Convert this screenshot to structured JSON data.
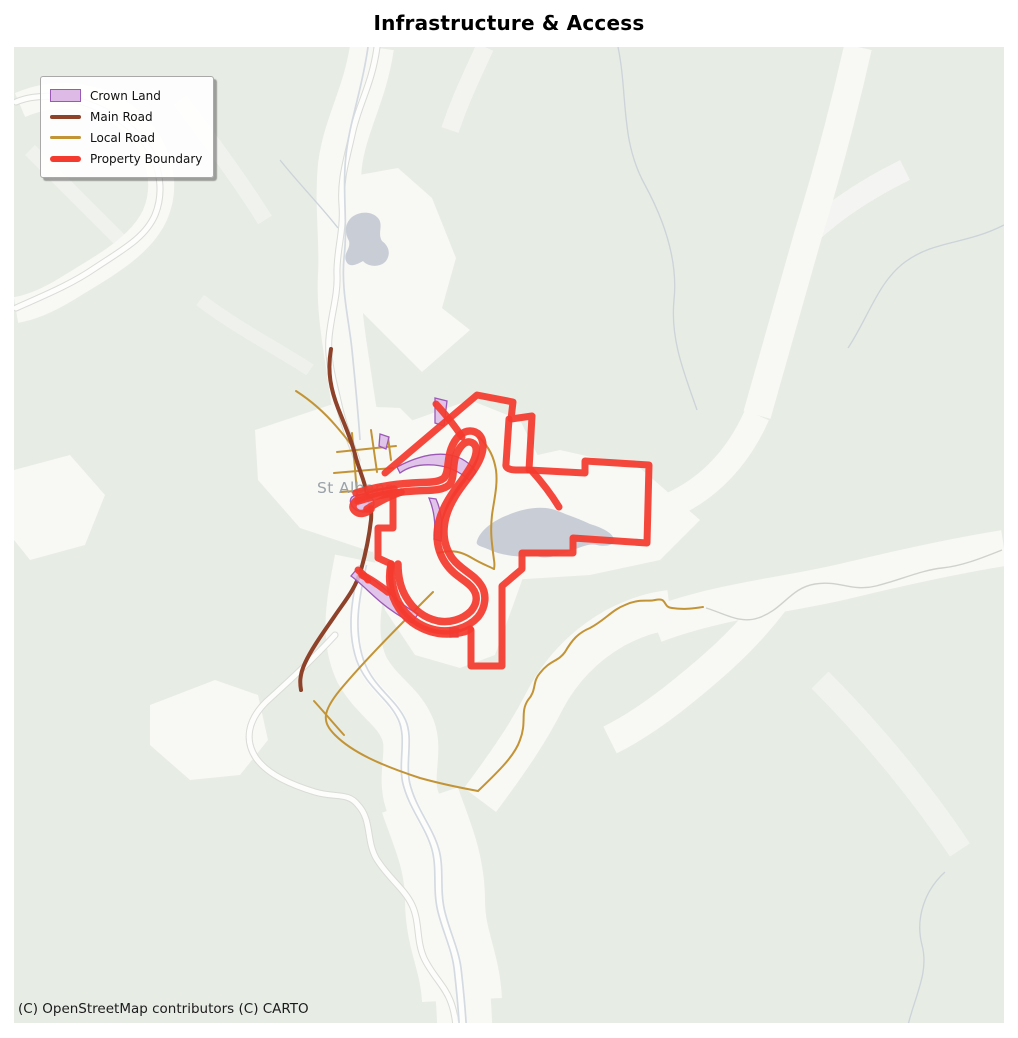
{
  "title": "Infrastructure & Access",
  "attribution": "(C) OpenStreetMap contributors (C) CARTO",
  "map_label": "St Albans",
  "legend": {
    "items": [
      {
        "label": "Crown Land",
        "swatch": "patch",
        "fill": "#ddbbe6",
        "edge": "#9b59b6"
      },
      {
        "label": "Main Road",
        "swatch": "line",
        "color": "#8d4229"
      },
      {
        "label": "Local Road",
        "swatch": "line",
        "color": "#c39436"
      },
      {
        "label": "Property Boundary",
        "swatch": "thick-line",
        "color": "#f43a2e"
      }
    ]
  },
  "colors": {
    "map_bg": "#e7ece5",
    "terrain_light": "#f8f8f5",
    "water": "#c9ced6",
    "river": "#d4dae1",
    "road_casing": "#d9dbd7",
    "road_fill": "#fdfdfb",
    "main_road": "#8d4229",
    "local_road": "#c39436",
    "boundary": "#f43a2e",
    "crown_fill": "#ddbbe6",
    "crown_edge": "#9b59b6",
    "label_gray": "#9aa2a9"
  }
}
